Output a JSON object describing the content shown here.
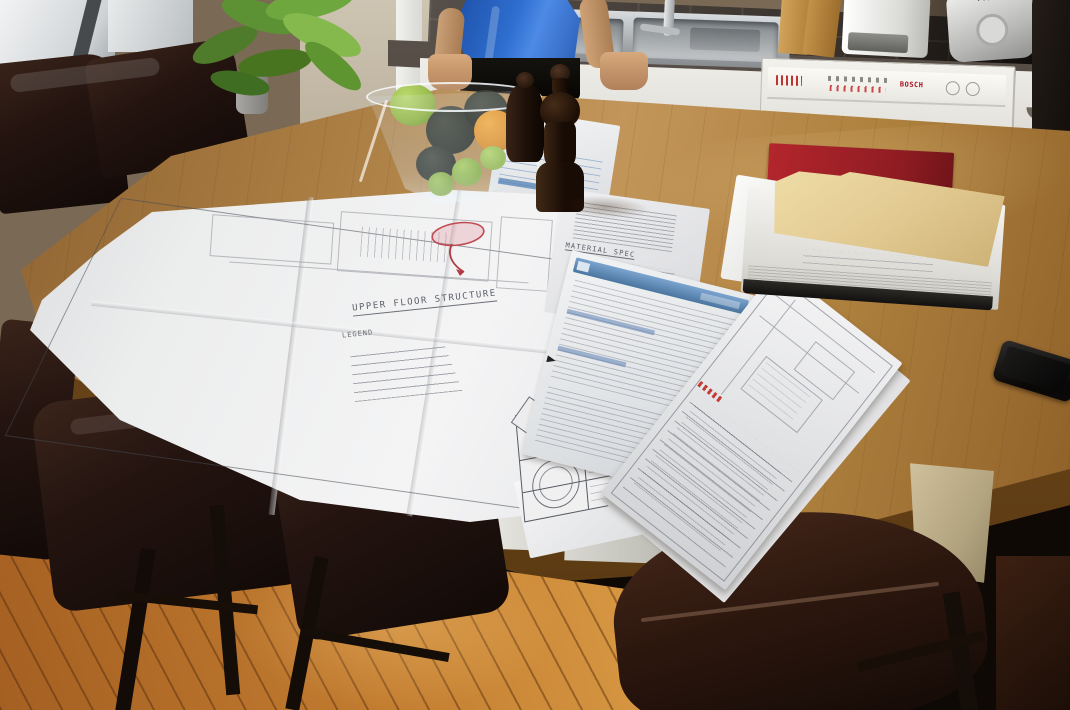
{
  "scene": {
    "type": "photograph",
    "setting": "Kitchen island table covered with folded construction blueprints, permit forms and document stacks",
    "people": "man in blue t-shirt leaning against the sink counter"
  },
  "blueprint": {
    "title": "UPPER FLOOR STRUCTURE",
    "legend_heading": "LEGEND"
  },
  "documents": {
    "spec_heading": "MATERIAL SPEC",
    "title_block_label": "PLAN"
  },
  "kitchen": {
    "dishwasher_brand": "BOSCH",
    "appliance_brand": "T-Fal"
  },
  "colors": {
    "form_header_blue": "#5b87b8",
    "annotation_red": "#c04a52",
    "binder_red": "#9e2328",
    "folder_manila": "#e4cd95",
    "shirt_blue": "#2f6fd0"
  }
}
